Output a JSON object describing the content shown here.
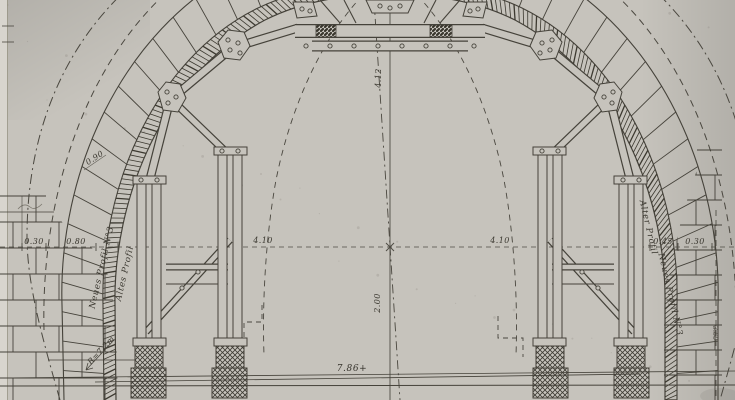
{
  "drawing": {
    "labels": {
      "neues_profil_left": "Neues Profil N°3",
      "altes_profil_left": "Altes Profil",
      "alter_profil_right": "Alter Profil",
      "neues_profil_right": "Neues Profil N°3",
      "radius": "R=7.2m",
      "right_edge": "3.60"
    },
    "dimensions": {
      "crown_height": "4.12",
      "mid_height": "2.00",
      "half_span_left": "4.10",
      "half_span_right": "4.10",
      "wall_left_a": "0.30",
      "wall_left_b": "0.80",
      "wall_right_a": "0.45",
      "wall_right_b": "0.30",
      "base_span": "7.86+",
      "ring_thickness": "0.90"
    },
    "colors": {
      "paper": "#c6c3bc",
      "ink": "#45423a",
      "ink_light": "#6e6a60"
    },
    "lining": {
      "voussoir_joint_count": 44,
      "hatch_stroke_count": 230
    }
  }
}
